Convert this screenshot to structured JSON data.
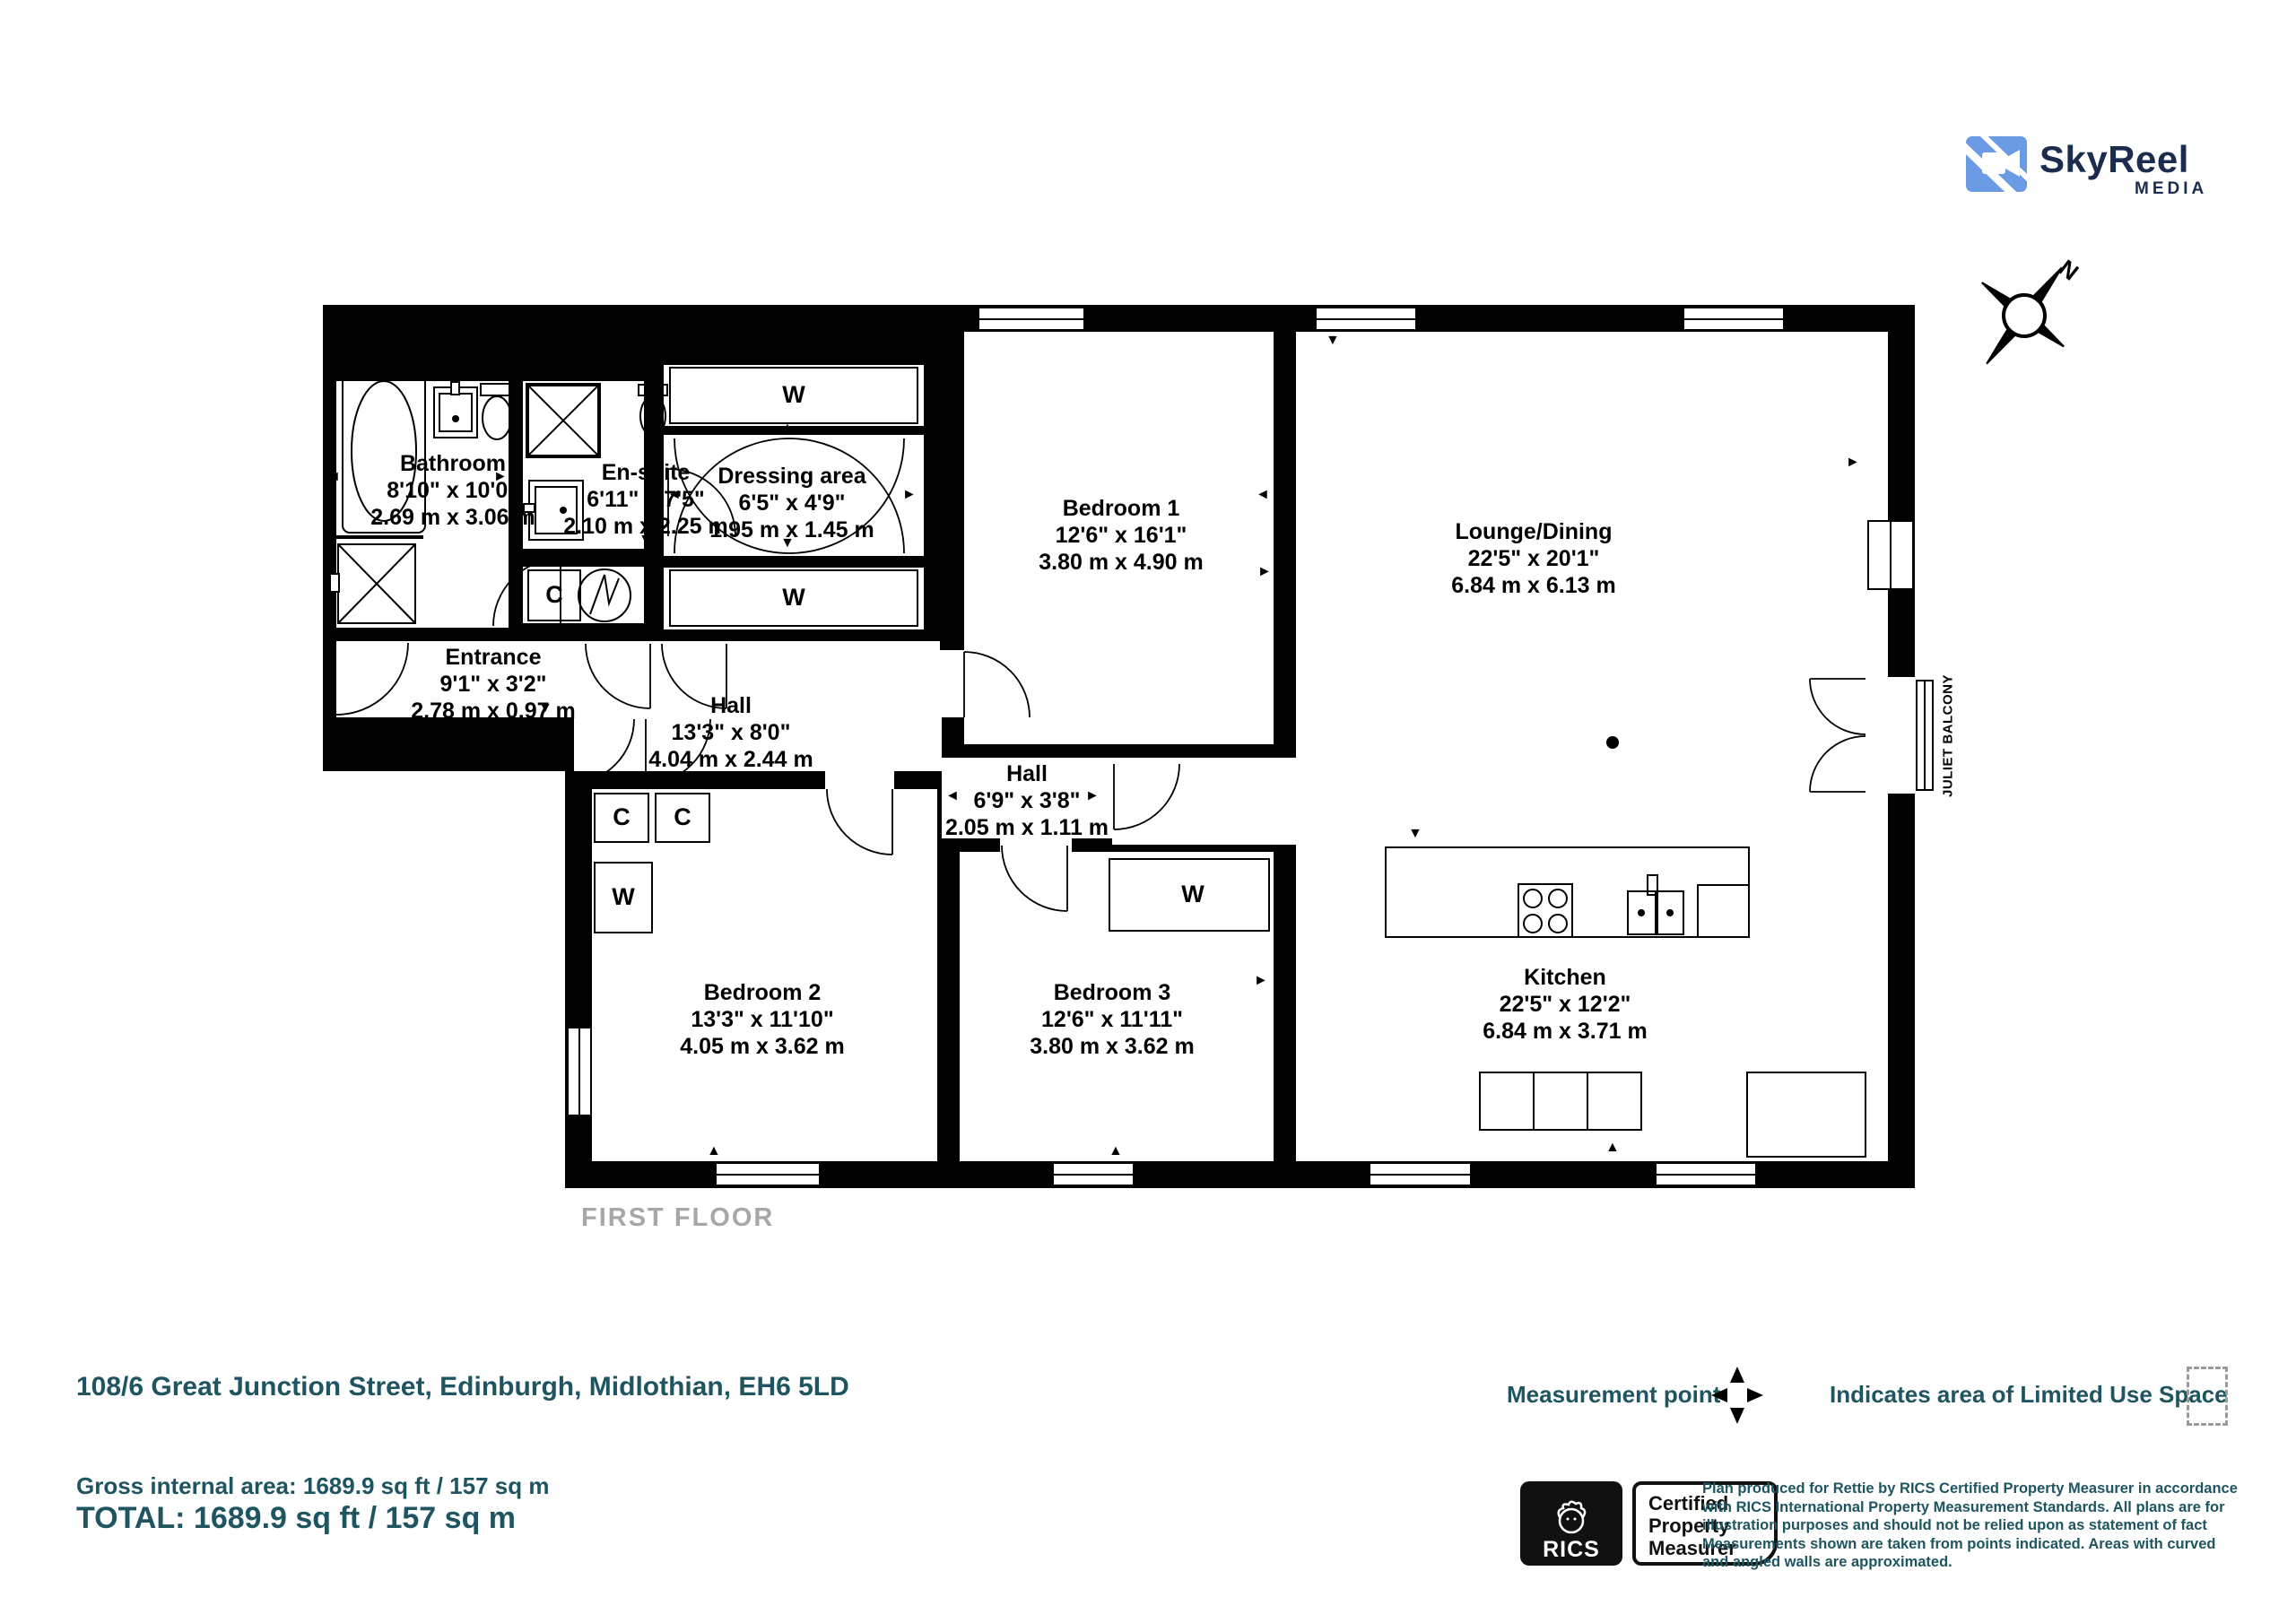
{
  "logo": {
    "name": "SkyReel",
    "sub": "MEDIA"
  },
  "compass": {
    "north_label": "N"
  },
  "plan": {
    "floor_label": "FIRST FLOOR",
    "wardrobe_label": "W",
    "cupboard_label": "C",
    "juliet_balcony_label": "JULIET BALCONY",
    "rooms": [
      {
        "name": "Bathroom",
        "imperial": "8'10\" x 10'0”",
        "metric": "2.69 m x 3.06 m"
      },
      {
        "name": "En-suite",
        "imperial": "6'11\" x 7'5\"",
        "metric": "2.10 m x 2.25 m"
      },
      {
        "name": "Dressing area",
        "imperial": "6'5\" x 4'9\"",
        "metric": "1.95 m x 1.45 m"
      },
      {
        "name": "Bedroom 1",
        "imperial": "12'6\" x 16'1\"",
        "metric": "3.80 m x 4.90 m"
      },
      {
        "name": "Lounge/Dining",
        "imperial": "22'5\" x 20'1\"",
        "metric": "6.84 m x 6.13 m"
      },
      {
        "name": "Entrance",
        "imperial": "9'1\" x 3'2\"",
        "metric": "2.78 m x 0.97 m"
      },
      {
        "name": "Hall",
        "imperial": "13'3\" x 8'0\"",
        "metric": "4.04 m x 2.44 m"
      },
      {
        "name": "Hall",
        "imperial": "6'9\" x 3'8\"",
        "metric": "2.05 m x 1.11 m"
      },
      {
        "name": "Bedroom 2",
        "imperial": "13'3\" x 11'10\"",
        "metric": "4.05 m x 3.62 m"
      },
      {
        "name": "Bedroom 3",
        "imperial": "12'6\" x 11'11\"",
        "metric": "3.80 m x 3.62 m"
      },
      {
        "name": "Kitchen",
        "imperial": "22'5\" x 12'2\"",
        "metric": "6.84 m x 3.71 m"
      }
    ]
  },
  "footer": {
    "address": "108/6 Great Junction Street, Edinburgh, Midlothian, EH6 5LD",
    "gross_area": "Gross internal area: 1689.9 sq ft / 157 sq m",
    "total": "TOTAL: 1689.9 sq ft / 157 sq m",
    "legend": {
      "measurement_point": "Measurement point",
      "limited_use": "Indicates area of  Limited Use Space"
    },
    "rics": {
      "brand": "RICS",
      "badge_line1": "Certified",
      "badge_line2": "Property",
      "badge_line3": "Measurer"
    },
    "disclaimer": "Plan produced for Rettie by RICS Certified Property Measurer in accordance with RICS International Property  Measurement Standards.  All plans are for illustration purposes and should not be relied upon as statement of fact Measurements shown are taken from points indicated. Areas with curved and angled walls are approximated."
  },
  "colors": {
    "teal": "#1e5560",
    "logo_blue": "#6b9be4",
    "logo_navy": "#1b2c4e",
    "gray": "#a7a7a7",
    "wall": "#000000"
  }
}
